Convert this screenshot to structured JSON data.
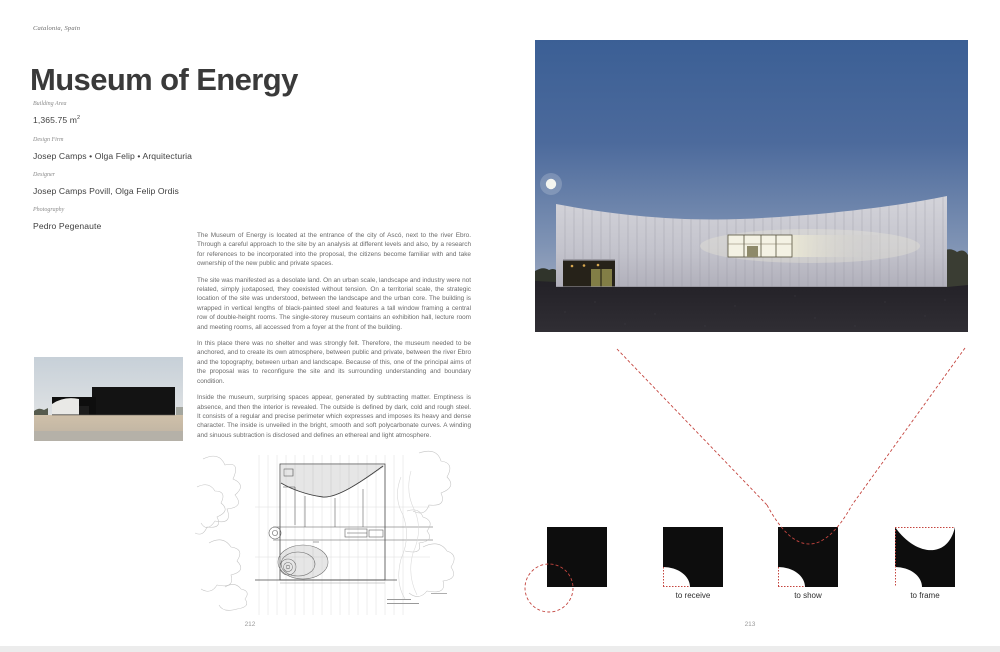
{
  "book": {
    "location": "Catalonia, Spain",
    "title": "Museum of Energy",
    "credits": {
      "area_label": "Building Area",
      "area_value": "1,365.75 m",
      "area_sup": "2",
      "firm_label": "Design Firm",
      "firm_value": "Josep Camps • Olga Felip • Arquitecturia",
      "designer_label": "Designer",
      "designer_value": "Josep Camps Povill, Olga Felip Ordis",
      "photo_label": "Photography",
      "photo_value": "Pedro Pegenaute"
    },
    "paragraphs": {
      "p1": "The Museum of Energy is located at the entrance of the city of Ascó, next to the river Ebro. Through a careful approach to the site by an analysis at different levels and also, by a research for references to be incorporated into the proposal, the citizens become familiar with and take ownership of the new public and private spaces.",
      "p2": "The site was manifested as a desolate land. On an urban scale, landscape and industry were not related, simply juxtaposed, they coexisted without tension. On a territorial scale, the strategic location of the site was understood, between the landscape and the urban core. The building is wrapped in vertical lengths of black-painted steel and features a tall window framing a central row of double-height rooms. The single-storey museum contains an exhibition hall, lecture room and meeting rooms, all accessed from a foyer at the front of the building.",
      "p3": "In this place there was no shelter and was strongly felt. Therefore, the museum needed to be anchored, and to create its own atmosphere, between public and private, between the river Ebro and the topography, between urban and landscape. Because of this, one of the principal aims of the proposal was to reconfigure the site and its surrounding understanding and boundary condition.",
      "p4": "Inside the museum, surprising spaces appear, generated by subtracting matter. Emptiness is absence, and then the interior is revealed. The outside is defined by dark, cold and rough steel. It consists of a regular and precise perimeter which expresses and imposes its heavy and dense character. The inside is unveiled in the bright, smooth and soft polycarbonate curves. A winding and sinuous subtraction is disclosed and defines an ethereal and light atmosphere."
    },
    "diagrams": {
      "d2": "to receive",
      "d3": "to show",
      "d4": "to frame"
    },
    "left_page_number": "212",
    "right_page_number": "213",
    "colors": {
      "annotation_red": "#c4453f",
      "sky_top": "#3b5f95",
      "sky_horizon": "#b3b7c6",
      "facade": "#c6c6ce",
      "ground": "#2a282d",
      "diagram_black": "#0d0d0d"
    }
  }
}
